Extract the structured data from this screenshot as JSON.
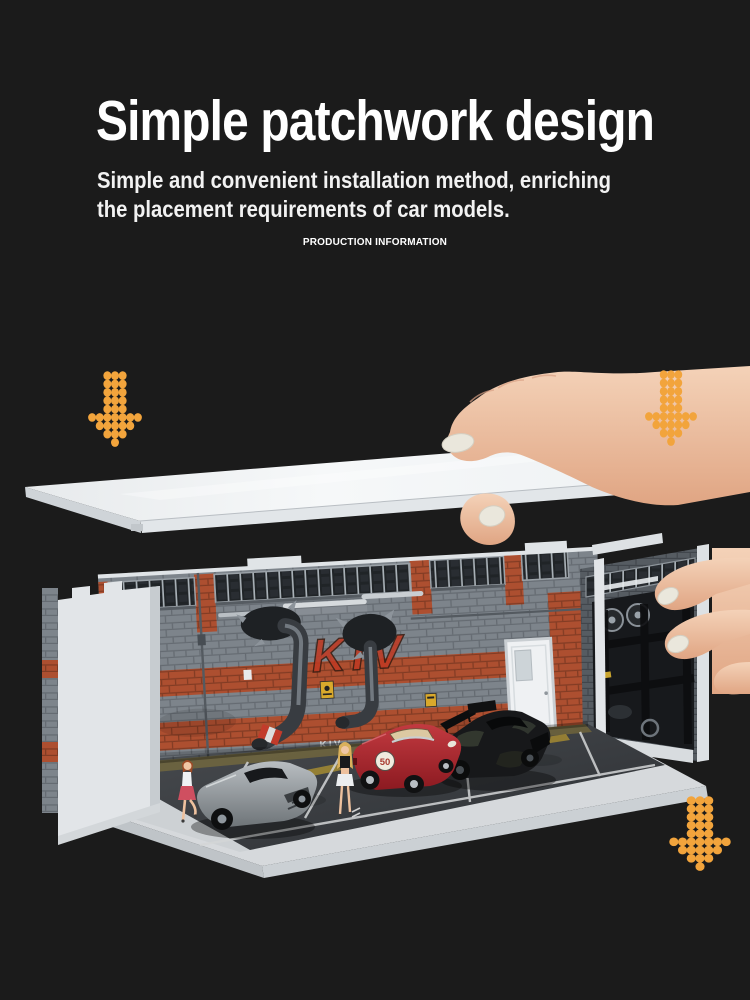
{
  "header": {
    "title": "Simple patchwork design",
    "subtitle_line1": "Simple and convenient installation method, enriching",
    "subtitle_line2": "the placement requirements of car models.",
    "kicker": "PRODUCTION INFORMATION"
  },
  "photo": {
    "wall_graffiti_large": "KIV",
    "wall_graffiti_small": "KIV",
    "car_roundel_number": "50"
  },
  "colors": {
    "background": "#1b1b1b",
    "arrow_accent": "#F2A43C",
    "brick_gray": "#7D848B",
    "brick_red": "#AD4F30",
    "porsche_red": "#A8242C",
    "lid_white": "#F2F4F6"
  },
  "icons": {
    "arrow_style": "dot-matrix-down-arrow"
  }
}
